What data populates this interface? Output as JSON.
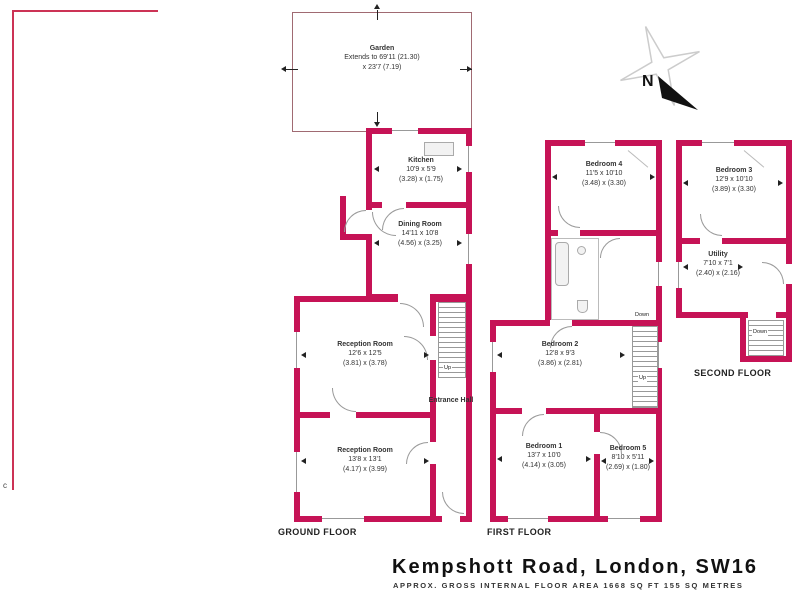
{
  "footer": {
    "title": "Kempshott Road, London, SW16",
    "subtitle": "APPROX. GROSS INTERNAL FLOOR AREA 1668 SQ FT 155 SQ METRES"
  },
  "compass": {
    "north": "N"
  },
  "boundary_mark": "c",
  "floor_labels": {
    "ground": "GROUND FLOOR",
    "first": "FIRST FLOOR",
    "second": "SECOND FLOOR"
  },
  "stairs": {
    "up": "Up",
    "down": "Down"
  },
  "garden": {
    "name": "Garden",
    "line1": "Extends to 69'11 (21.30)",
    "line2": "x 23'7 (7.19)"
  },
  "rooms": {
    "kitchen": {
      "name": "Kitchen",
      "imperial": "10'9 x 5'9",
      "metric": "(3.28) x (1.75)"
    },
    "dining": {
      "name": "Dining Room",
      "imperial": "14'11 x 10'8",
      "metric": "(4.56) x (3.25)"
    },
    "reception1": {
      "name": "Reception Room",
      "imperial": "12'6 x 12'5",
      "metric": "(3.81) x (3.78)"
    },
    "reception2": {
      "name": "Reception Room",
      "imperial": "13'8 x 13'1",
      "metric": "(4.17) x (3.99)"
    },
    "entrance_hall": {
      "name": "Entrance Hall"
    },
    "bedroom4": {
      "name": "Bedroom 4",
      "imperial": "11'5 x 10'10",
      "metric": "(3.48) x (3.30)"
    },
    "bedroom2": {
      "name": "Bedroom 2",
      "imperial": "12'8 x 9'3",
      "metric": "(3.86) x (2.81)"
    },
    "bedroom1": {
      "name": "Bedroom 1",
      "imperial": "13'7 x 10'0",
      "metric": "(4.14) x (3.05)"
    },
    "bedroom5": {
      "name": "Bedroom 5",
      "imperial": "8'10 x 5'11",
      "metric": "(2.69) x (1.80)"
    },
    "bedroom3": {
      "name": "Bedroom 3",
      "imperial": "12'9 x 10'10",
      "metric": "(3.89) x (3.30)"
    },
    "utility": {
      "name": "Utility",
      "imperial": "7'10 x 7'1",
      "metric": "(2.40) x (2.16)"
    }
  },
  "colors": {
    "wall": "#c61356",
    "garden_line": "#a06a72",
    "boundary": "#cc3355"
  }
}
